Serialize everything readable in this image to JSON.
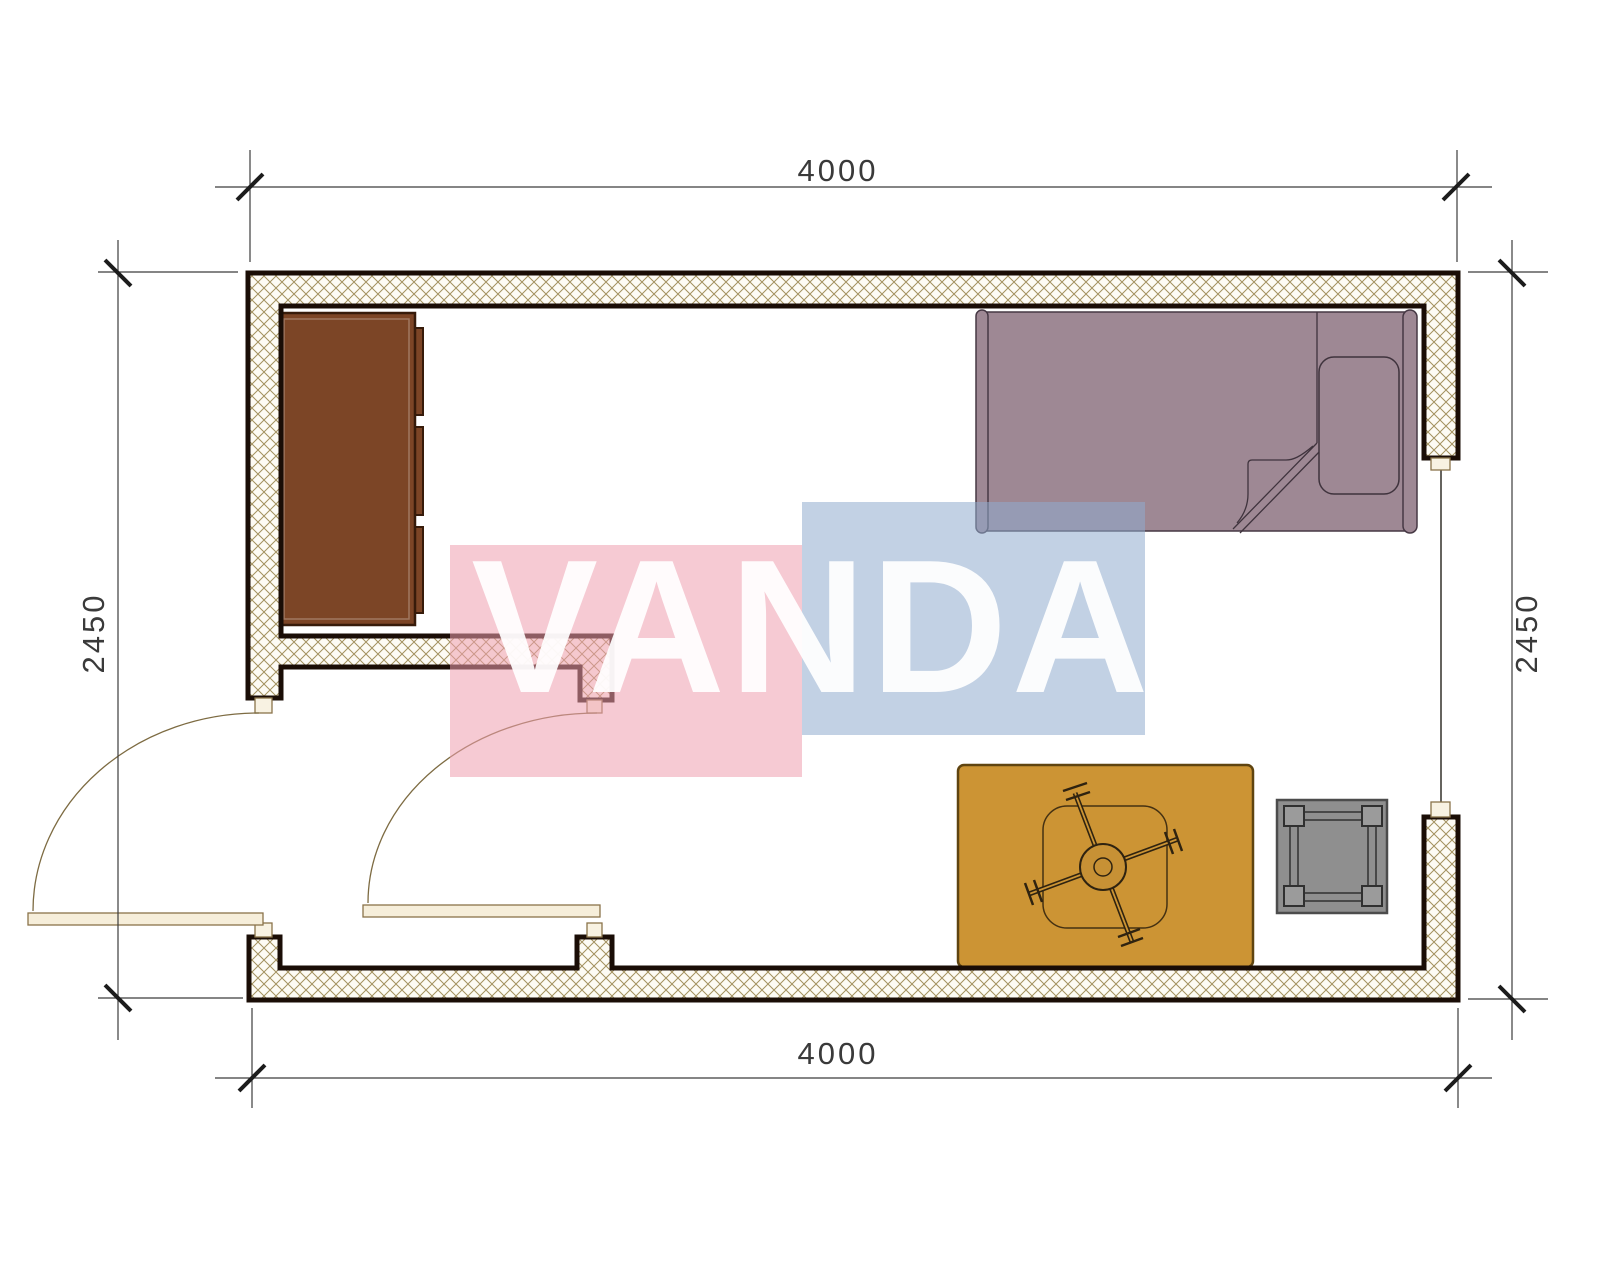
{
  "page": {
    "title": "Room floor plan drawing"
  },
  "dimensions": {
    "top": "4000",
    "bottom": "4000",
    "left": "2450",
    "right": "2450"
  },
  "watermark": {
    "text": "VANDA",
    "pink_block_color": "#ee9fae",
    "blue_block_color": "#8fabce",
    "text_color": "#ffffff"
  },
  "colors": {
    "wall_outline": "#1a0d06",
    "wall_hatch_line": "#a3915f",
    "wall_hatch_bg": "#fdfbf4",
    "dresser": "#7c4526",
    "bed": "#9e8894",
    "rug": "#cc9434",
    "chair_hub": "#c79135",
    "side_table": "#8f8f8f",
    "door_leaf": "#f6eeda",
    "door_arc": "#7d6b42",
    "dimension_line": "#3c3c3c",
    "dimension_text": "#3a3a3a"
  }
}
